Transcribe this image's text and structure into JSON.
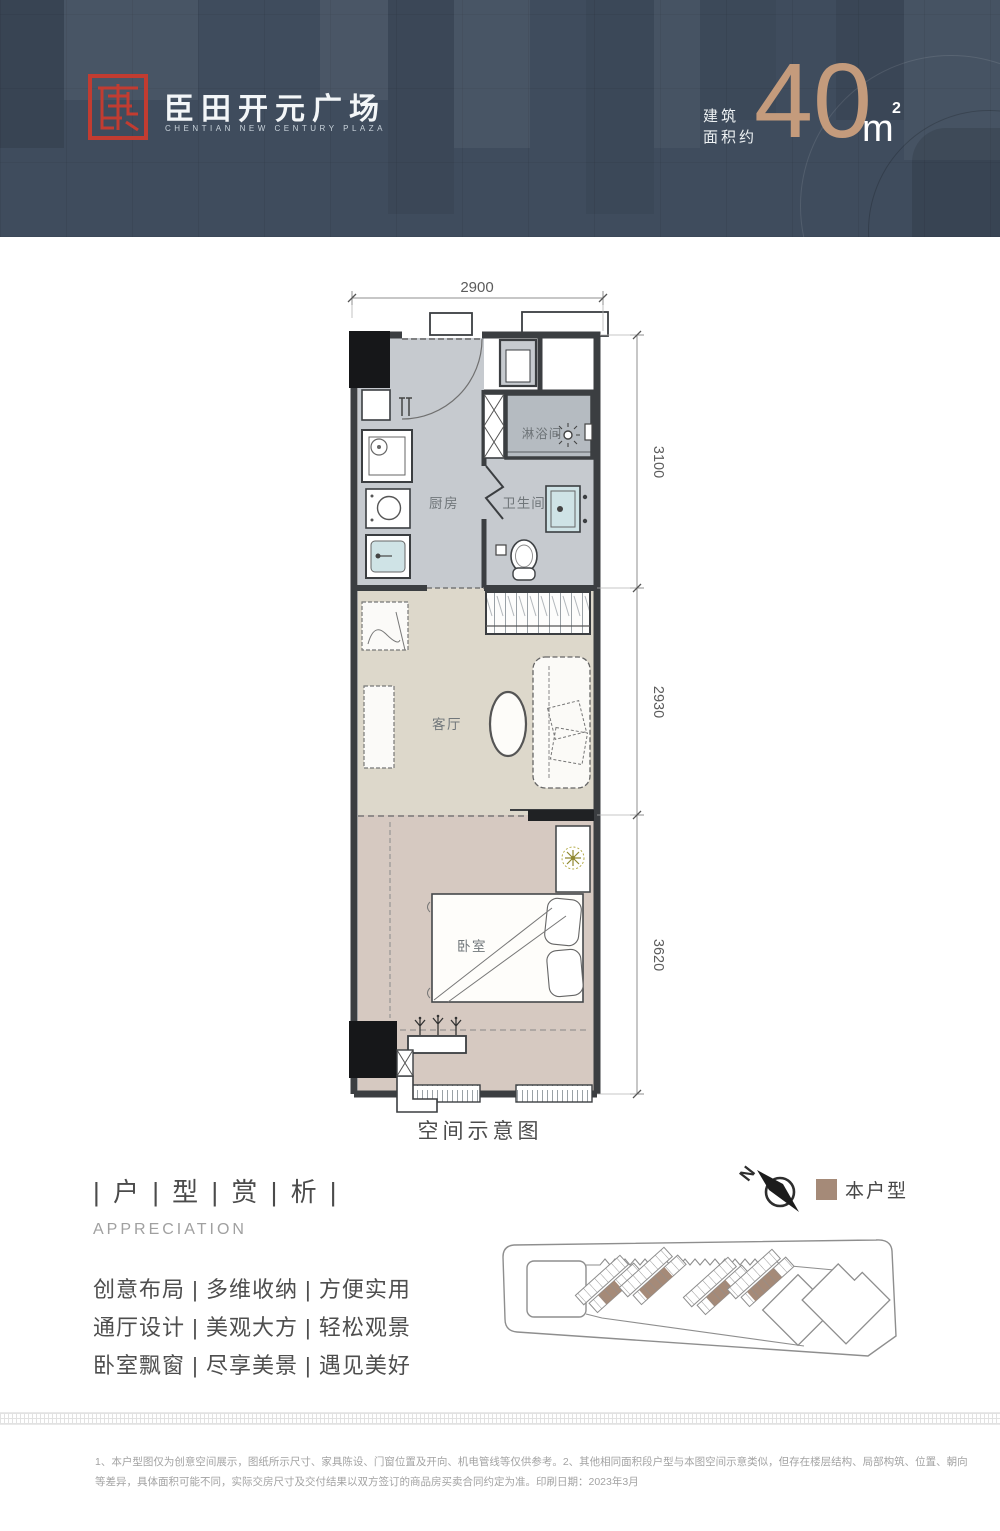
{
  "header": {
    "brand_cn": "臣田开元广场",
    "brand_en": "CHENTIAN NEW CENTURY PLAZA",
    "area_label_line1": "建筑",
    "area_label_line2": "面积约",
    "area_value": "40",
    "area_unit": "m",
    "area_exponent": "2"
  },
  "colors": {
    "header_bg": "#3f4c5d",
    "logo_red": "#c23c31",
    "area_accent": "#c49b7c",
    "unit_swatch": "#a58a78",
    "wall": "#3b3e41",
    "floor_gray": "#c6cacf",
    "floor_shower": "#b5bbc1",
    "floor_living": "#ddd8cb",
    "floor_bedroom": "#d6c9c1"
  },
  "floorplan": {
    "caption": "空间示意图",
    "dim_top": "2900",
    "dim_right_top": "3100",
    "dim_right_middle": "2930",
    "dim_right_bottom": "3620",
    "room_kitchen": "厨房",
    "room_shower": "淋浴间",
    "room_bath": "卫生间",
    "room_living": "客厅",
    "room_bedroom": "卧室"
  },
  "appreciation": {
    "title": "| 户 | 型 | 赏 | 析 |",
    "subtitle": "APPRECIATION",
    "features": [
      "创意布局 | 多维收纳 | 方便实用",
      "通厅设计 | 美观大方 | 轻松观景",
      "卧室飘窗 | 尽享美景 | 遇见美好"
    ]
  },
  "sitemap": {
    "north_label": "N",
    "legend_label": "本户型"
  },
  "footer": {
    "disclaimer_line1": "1、本户型图仅为创意空间展示，图纸所示尺寸、家具陈设、门窗位置及开向、机电管线等仅供参考。2、其他相同面积段户型与本图空间示意类似，但存在楼层结构、局部构筑、位置、朝向",
    "disclaimer_line2": "等差异，具体面积可能不同，实际交房尺寸及交付结果以双方签订的商品房买卖合同约定为准。印刷日期：2023年3月"
  }
}
